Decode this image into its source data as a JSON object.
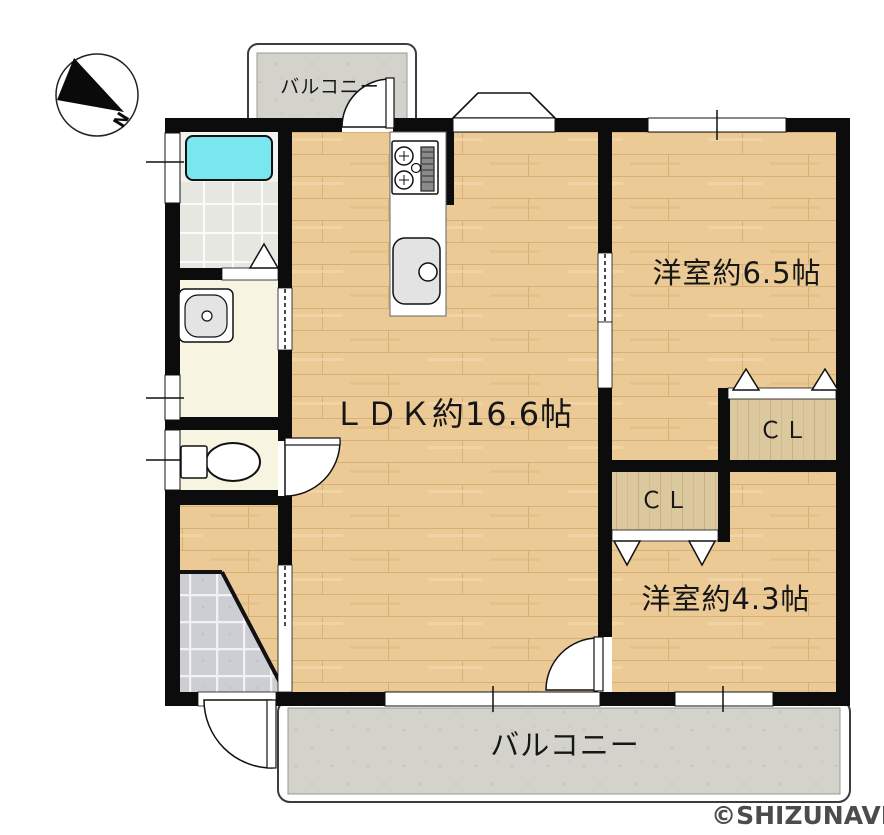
{
  "compass": {
    "label": "N"
  },
  "balconies": {
    "top": {
      "label": "バルコニー"
    },
    "bottom": {
      "label": "バルコニー"
    }
  },
  "rooms": {
    "ldk": {
      "label": "ＬＤＫ約16.6帖",
      "size_jo": 16.6
    },
    "western_65": {
      "label": "洋室約6.5帖",
      "size_jo": 6.5
    },
    "western_43": {
      "label": "洋室約4.3帖",
      "size_jo": 4.3
    },
    "closet_upper": {
      "label": "ＣＬ"
    },
    "closet_lower": {
      "label": "ＣＬ"
    }
  },
  "watermark": {
    "label": "©SHIZUNAVI"
  },
  "icons": [
    "compass-north-icon",
    "bathtub-icon",
    "washbasin-icon",
    "toilet-icon",
    "gas-stove-icon",
    "kitchen-sink-icon",
    "door-swing-icon",
    "folding-door-icon",
    "sliding-door-icon",
    "window-icon"
  ],
  "colors": {
    "wall": "#0c0c0c",
    "wood_floor": "#ecca96",
    "wood_line": "#d7b077",
    "closet_floor": "#dcc89e",
    "balcony": "#d3d3cc",
    "bath_tile": "#e7e7e2",
    "cream_floor": "#f7f5e2",
    "genkan_tile": "#cdced4",
    "bathtub": "#79e7f0",
    "watermark_gray": "#4c4c4c"
  }
}
